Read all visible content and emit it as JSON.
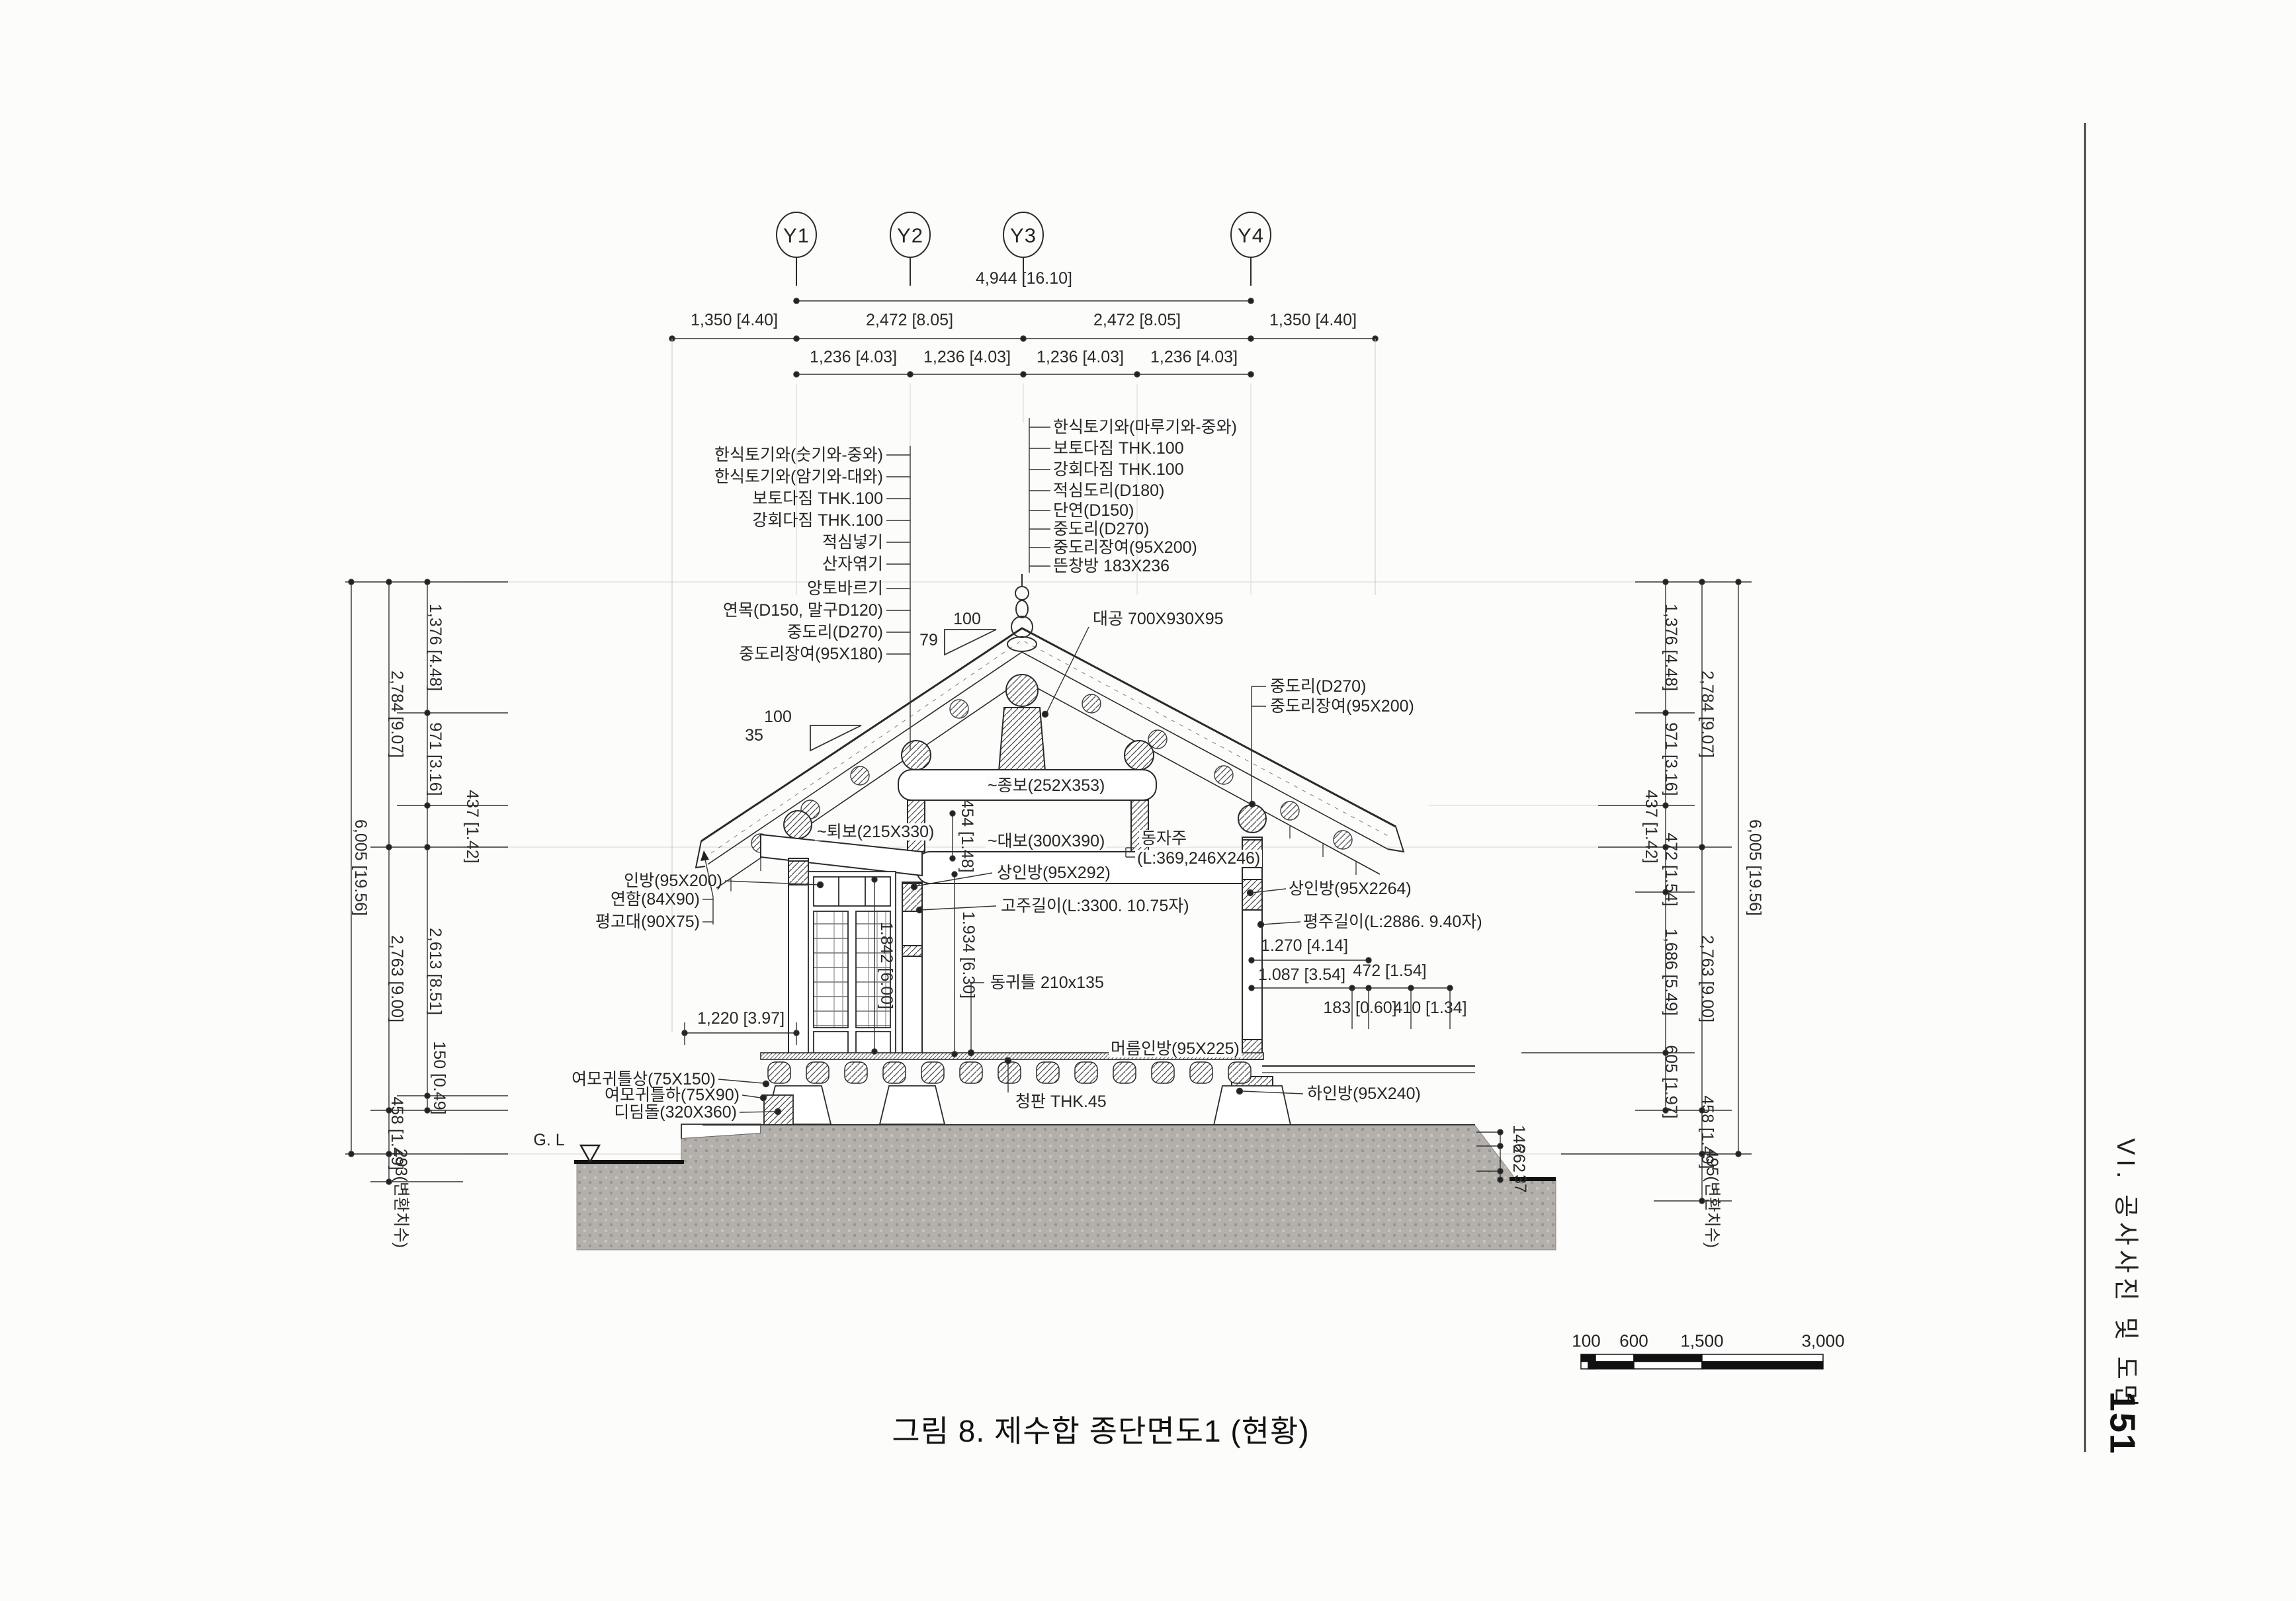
{
  "page": {
    "caption": "그림 8. 제수합 종단면도1 (현황)",
    "side_title": "VI. 공사사진 및 도면",
    "page_number": "151"
  },
  "grid": {
    "y1": "Y1",
    "y2": "Y2",
    "y3": "Y3",
    "y4": "Y4"
  },
  "dims_top": {
    "overall": "4,944 [16.10]",
    "left_overhang": "1,350 [4.40]",
    "span_left": "2,472 [8.05]",
    "span_right": "2,472 [8.05]",
    "right_overhang": "1,350 [4.40]",
    "quarters": [
      "1,236 [4.03]",
      "1,236 [4.03]",
      "1,236 [4.03]",
      "1,236 [4.03]"
    ]
  },
  "roof_layers_left": [
    "한식토기와(숫기와-중와)",
    "한식토기와(암기와-대와)",
    "보토다짐 THK.100",
    "강회다짐 THK.100",
    "적심넣기",
    "산자엮기",
    "앙토바르기",
    "연목(D150, 말구D120)",
    "중도리(D270)",
    "중도리장여(95X180)"
  ],
  "roof_layers_ridge": [
    "한식토기와(마루기와-중와)",
    "보토다짐 THK.100",
    "강회다짐 THK.100",
    "적심도리(D180)",
    "단연(D150)",
    "중도리(D270)",
    "중도리장여(95X200)",
    "뜬창방 183X236"
  ],
  "purlin_right": [
    "중도리(D270)",
    "중도리장여(95X200)"
  ],
  "slopes": {
    "ridge_run": "100",
    "ridge_rise": "79",
    "eave_run": "100",
    "eave_rise": "35"
  },
  "members": {
    "daegong": "대공 700X930X95",
    "jongbo": "~종보(252X353)",
    "toebo": "~퇴보(215X330)",
    "daebo": "~대보(300X390)",
    "dongjaju_1": "동자주",
    "dongjaju_2": "(L:369,246X246)",
    "sanginbang_left": "상인방(95X292)",
    "sanginbang_right": "상인방(95X2264)",
    "inbang": "인방(95X200)",
    "yeonham": "연함(84X90)",
    "pyeonggodae": "평고대(90X75)",
    "goju": "고주길이(L:3300. 10.75자)",
    "pyeongju": "평주길이(L:2886. 9.40자)",
    "donggwiteul": "동귀틀 210x135",
    "meoreum_inbang": "머름인방(95X225)",
    "ha_inbang": "하인방(95X240)",
    "yeomo_sang": "여모귀틀상(75X150)",
    "yeomo_ha": "여모귀틀하(75X90)",
    "didimdol": "디딤돌(320X360)",
    "cheongpan": "청판 THK.45",
    "ground_level": "G. L"
  },
  "dims_inner": {
    "door_width": "1,220 [3.97]",
    "door_height": "1.842 [6.00]",
    "goju_height": "1.934 [6.30]",
    "beam_offset": "454 [1.48]",
    "bay_right": "1.270 [4.14]",
    "d1087": "1.087 [3.54]",
    "d472": "472 [1.54]",
    "d183": "183 [0.60]",
    "d410": "410 [1.34]"
  },
  "chain_left": {
    "total": "6,005 [19.56]",
    "upper": "2,784 [9.07]",
    "lower": "2,763 [9.00]",
    "base": "458 [1.49]",
    "below": "293(변환치수)",
    "segments": [
      "1,376 [4.48]",
      "971 [3.16]",
      "437 [1.42]",
      "2,613 [8.51]",
      "150 [0.49]"
    ]
  },
  "chain_right": {
    "total": "6,005 [19.56]",
    "upper": "2,784 [9.07]",
    "lower": "2,763 [9.00]",
    "base": "458 [1.49]",
    "below": "495(변환치수)",
    "segments": [
      "1,376 [4.48]",
      "971 [3.16]",
      "437 [1.42]",
      "472 [1.54]",
      "1,686 [5.49]",
      "605 [1.97]"
    ],
    "ground_steps": [
      "146",
      "262",
      "37"
    ]
  },
  "scalebar": {
    "ticks": [
      "100",
      "600",
      "1,500",
      "3,000"
    ]
  }
}
